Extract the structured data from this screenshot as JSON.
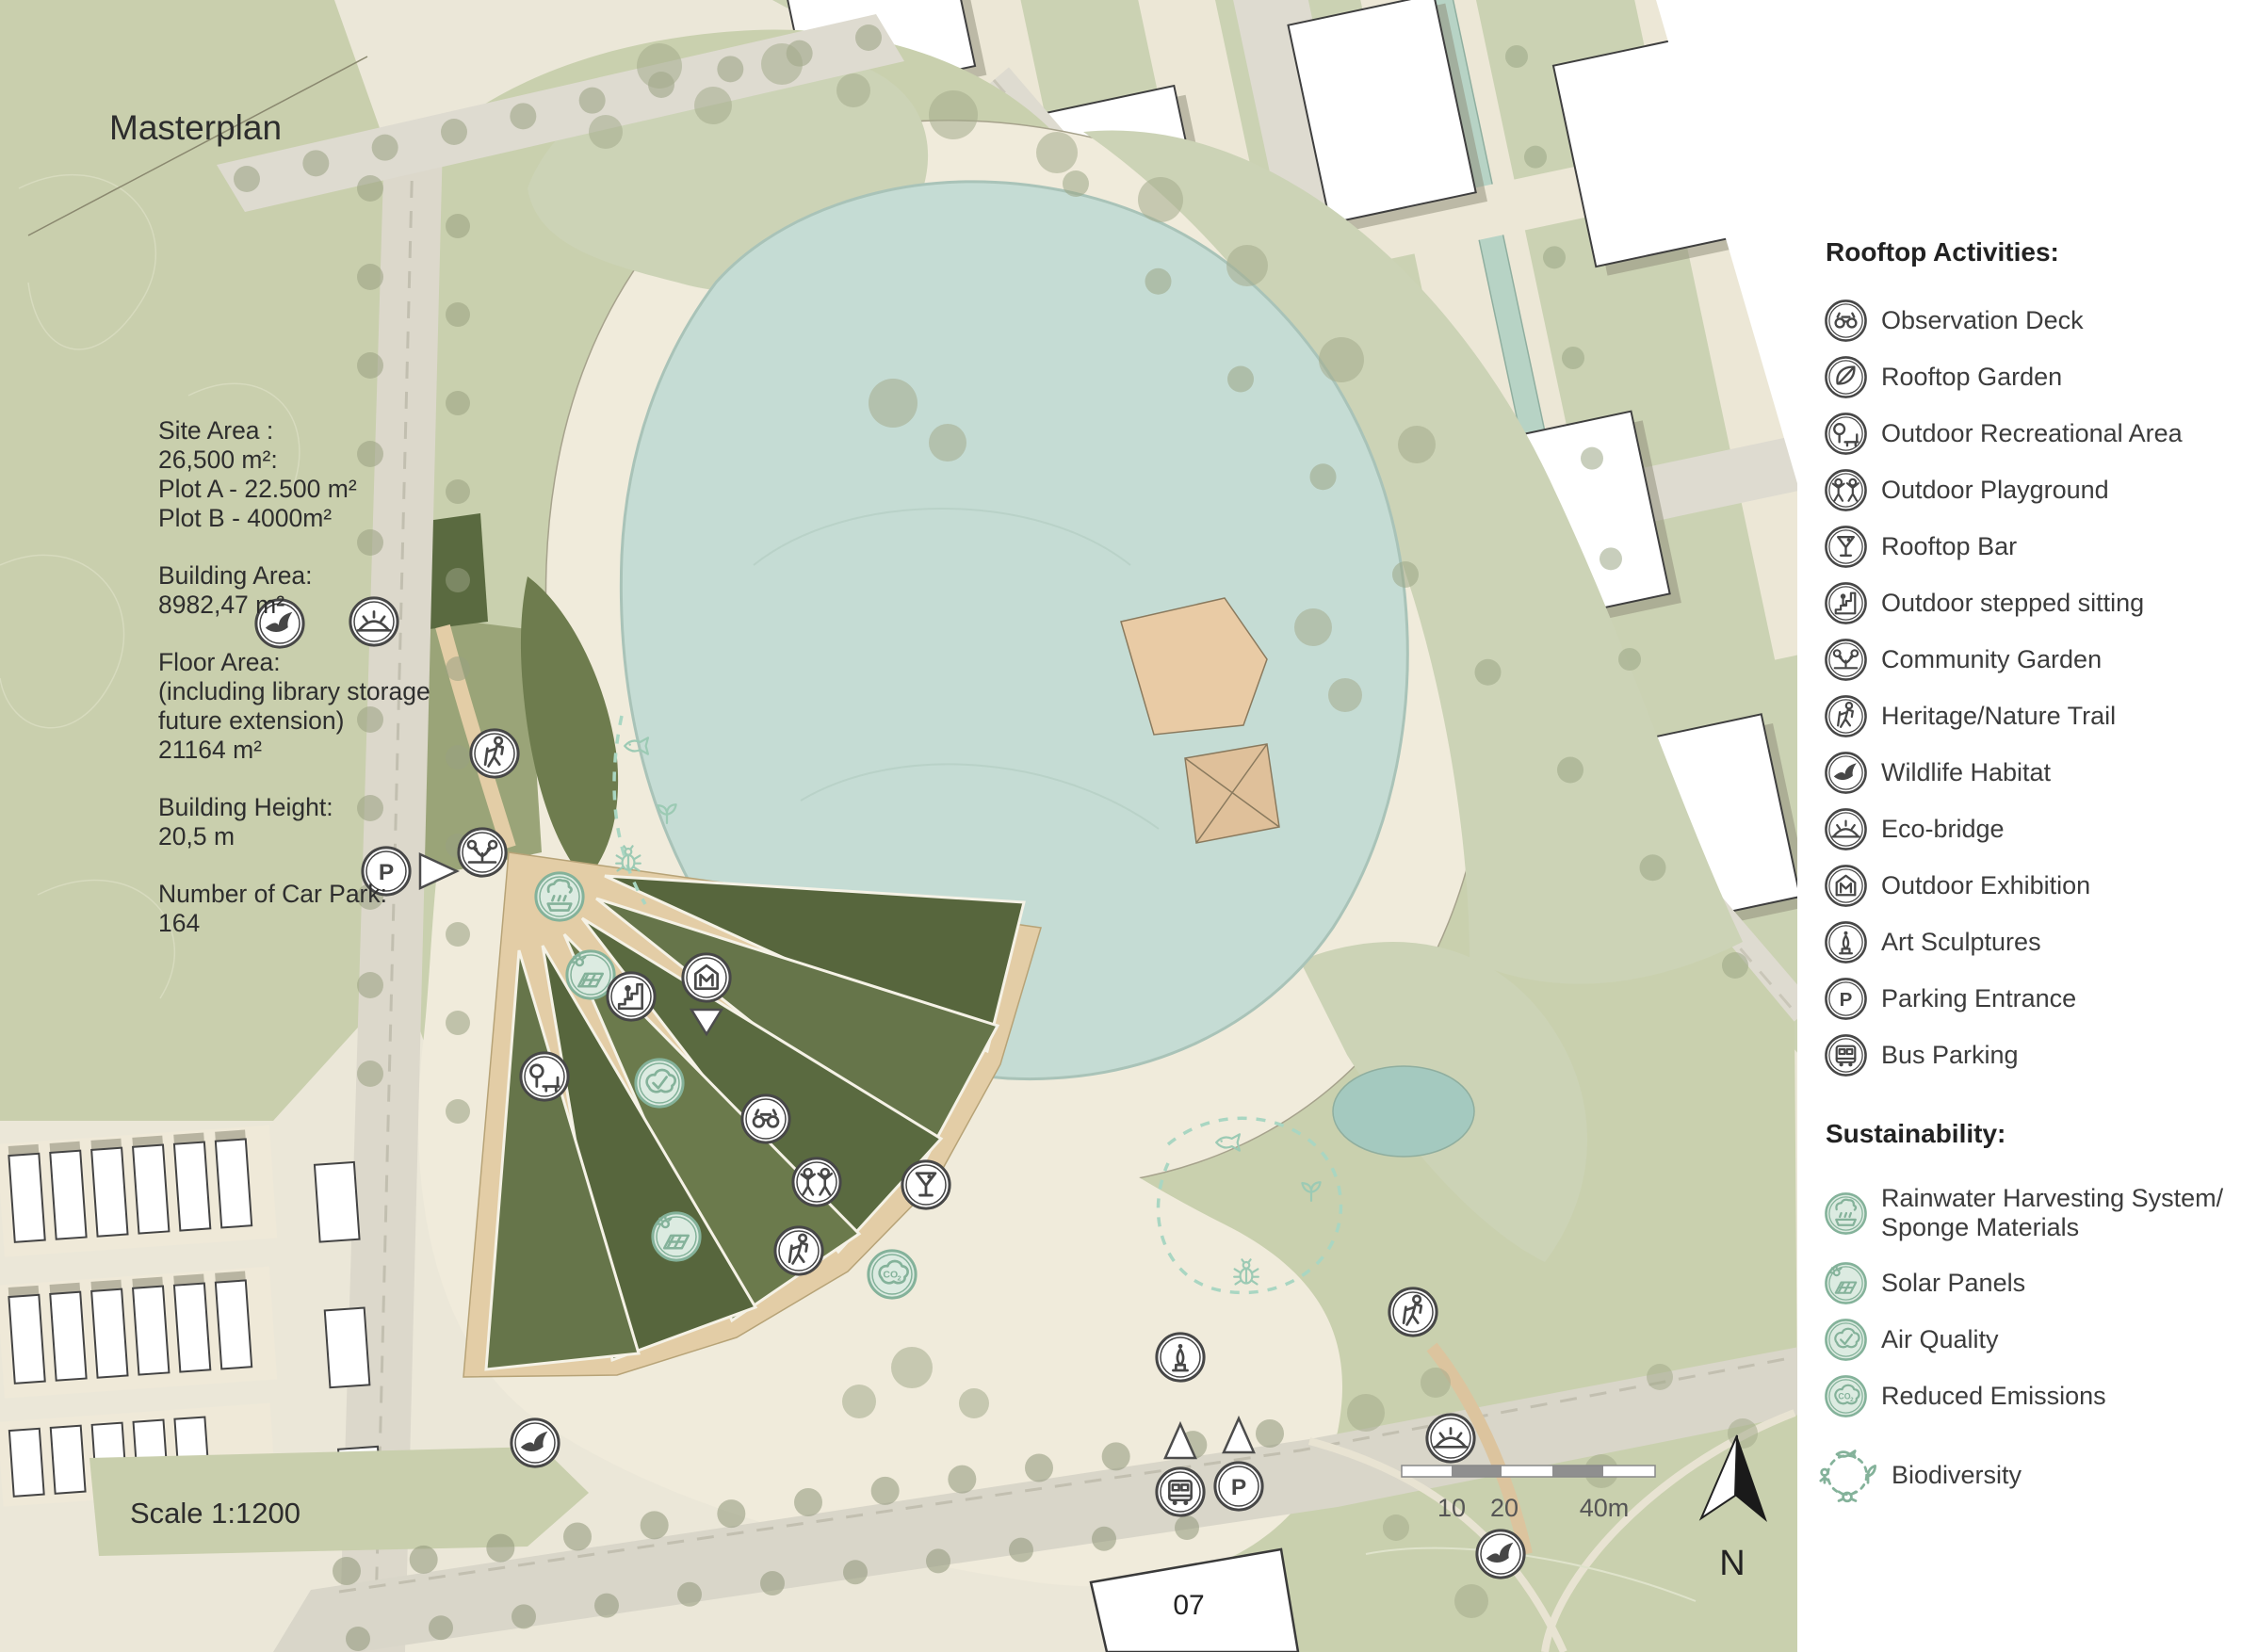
{
  "title": "Masterplan",
  "scale_label": "Scale 1:1200",
  "building_label": "07",
  "north_label": "N",
  "scalebar": {
    "labels": [
      "10",
      "20",
      "40m"
    ]
  },
  "stats": [
    {
      "lines": [
        "Site Area :",
        "26,500 m²:",
        "Plot A - 22.500 m²",
        "Plot B - 4000m²"
      ]
    },
    {
      "lines": [
        "Building Area:",
        "8982,47 m²"
      ]
    },
    {
      "lines": [
        "Floor Area:",
        "(including library storage",
        "future extension)",
        "21164 m²"
      ]
    },
    {
      "lines": [
        "Building Height:",
        "20,5 m"
      ]
    },
    {
      "lines": [
        "Number of Car Park:",
        "164"
      ]
    }
  ],
  "legend": {
    "rooftop_header": "Rooftop Activities:",
    "rooftop_items": [
      {
        "icon": "observation-deck-icon",
        "label": "Observation Deck"
      },
      {
        "icon": "rooftop-garden-icon",
        "label": "Rooftop Garden"
      },
      {
        "icon": "outdoor-recreational-area-icon",
        "label": "Outdoor Recreational Area"
      },
      {
        "icon": "outdoor-playground-icon",
        "label": "Outdoor Playground"
      },
      {
        "icon": "rooftop-bar-icon",
        "label": "Rooftop Bar"
      },
      {
        "icon": "outdoor-stepped-sitting-icon",
        "label": "Outdoor stepped sitting"
      },
      {
        "icon": "community-garden-icon",
        "label": "Community Garden"
      },
      {
        "icon": "heritage-nature-trail-icon",
        "label": "Heritage/Nature Trail"
      },
      {
        "icon": "wildlife-habitat-icon",
        "label": "Wildlife Habitat"
      },
      {
        "icon": "eco-bridge-icon",
        "label": "Eco-bridge"
      },
      {
        "icon": "outdoor-exhibition-icon",
        "label": "Outdoor Exhibition"
      },
      {
        "icon": "art-sculptures-icon",
        "label": "Art Sculptures"
      },
      {
        "icon": "parking-entrance-icon",
        "label": "Parking Entrance"
      },
      {
        "icon": "bus-parking-icon",
        "label": "Bus Parking"
      }
    ],
    "sustainability_header": "Sustainability:",
    "sustainability_items": [
      {
        "icon": "rainwater-icon",
        "label": "Rainwater Harvesting System/",
        "label2": "Sponge Materials"
      },
      {
        "icon": "solar-panels-icon",
        "label": "Solar Panels"
      },
      {
        "icon": "air-quality-icon",
        "label": "Air Quality"
      },
      {
        "icon": "reduced-emissions-icon",
        "label": "Reduced Emissions"
      },
      {
        "icon": "biodiversity-icon",
        "label": "Biodiversity"
      }
    ]
  },
  "colors": {
    "park_green": "#c9cfad",
    "pond": "#c5dcd4",
    "roof_dark_green": "#5a6a40",
    "path_tan": "#e3cda6",
    "canal_teal": "#b7d3c5",
    "sustainability_green": "#84b29a"
  }
}
